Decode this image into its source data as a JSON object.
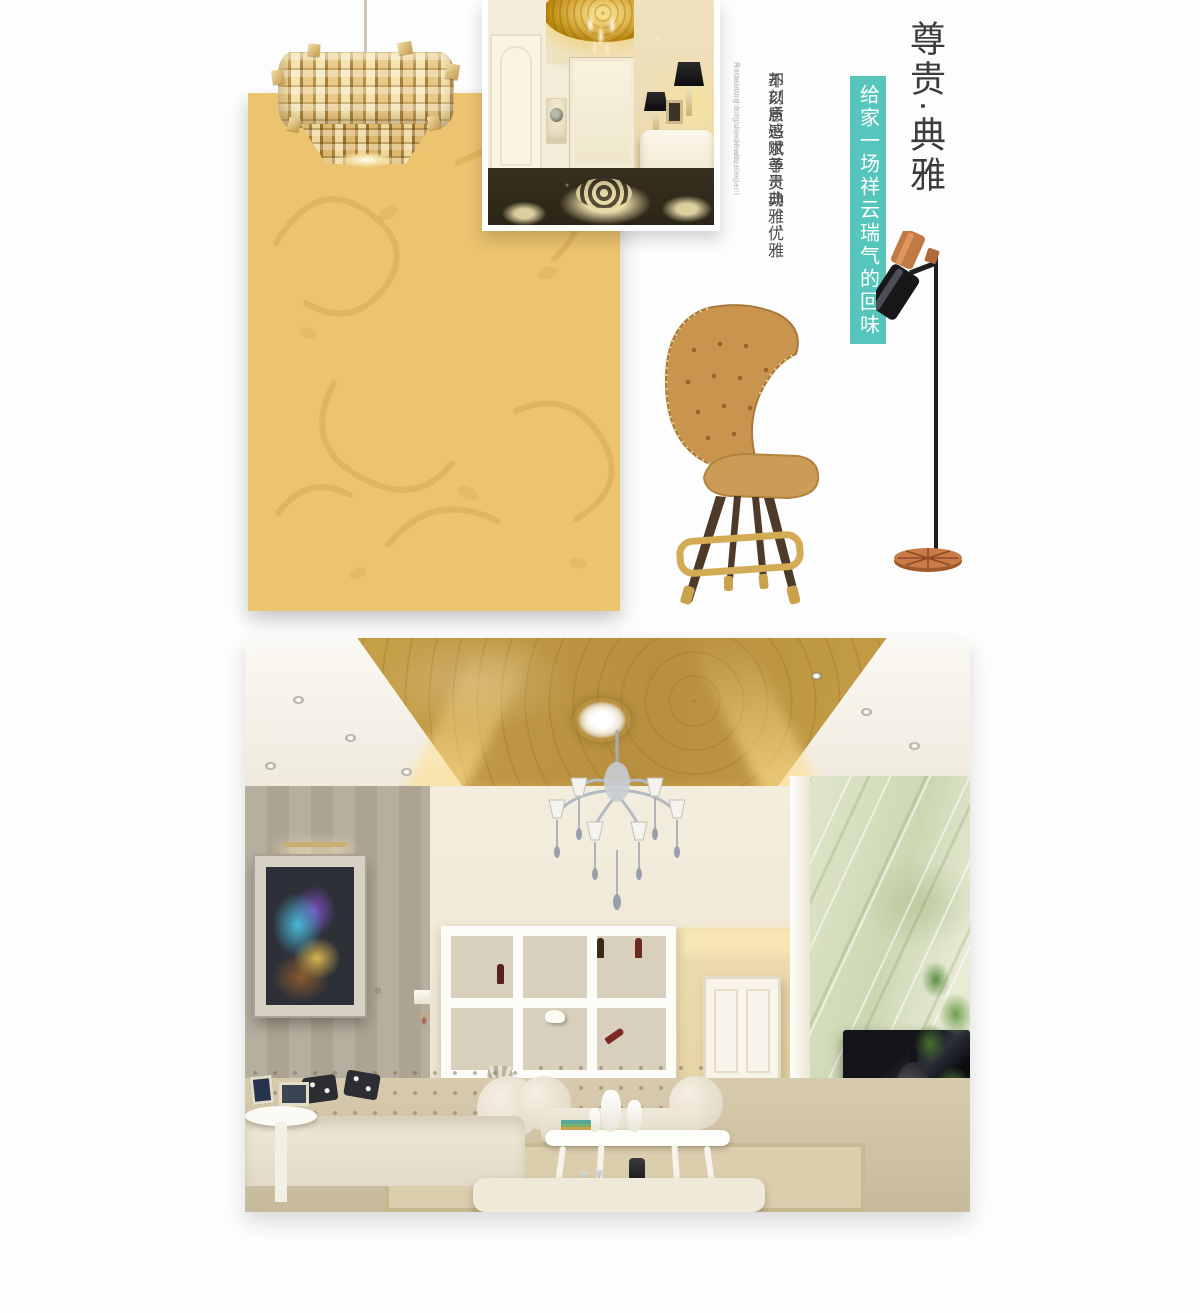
{
  "colors": {
    "accent_teal": "#56c6bc",
    "wallpaper_gold": "#ecc46f",
    "title_ink": "#3c3c3c",
    "tagline_ink": "#4c4c4c",
    "english_gray": "#c8c8c8"
  },
  "hero": {
    "title": "尊贵·典雅",
    "banner_vertical_text": "给家一场祥云瑞气的回味",
    "tagline_col_right": "不刻意追求尊贵典雅，",
    "tagline_col_left": "却以质感赋予灵动、优雅",
    "english_cols": [
      "A turn to the home of aftertaste,",
      "Refraining from luxurious,",
      "He texture to give clever, elegant"
    ]
  },
  "images": {
    "wallpaper_swatch": "gold embossed scroll wallpaper swatch",
    "chandelier": "gold mosaic-plate pendant chandelier",
    "hallway": "european hallway with gold dome ceiling",
    "bar_stool": "tan tufted leather bar stool",
    "floor_lamp": "black and copper floor lamp",
    "living_room": "european living room with gold wallpaper ceiling"
  }
}
